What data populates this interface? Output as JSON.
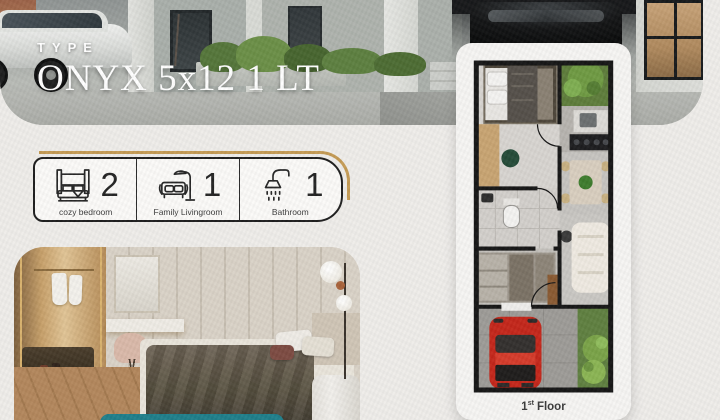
{
  "colors": {
    "background": "#efedea",
    "accent_gold": "#c59b55",
    "teal_cta": "#1f7f8b",
    "ink": "#232323",
    "card": "#f6f5f3",
    "plan_wall": "#161616",
    "car_red": "#c4271b",
    "grass_green": "#5f8040"
  },
  "header": {
    "type_label": "TYPE",
    "title": "ONYX 5x12 1 LT"
  },
  "features": {
    "items": [
      {
        "icon": "bed-icon",
        "count": "2",
        "label": "cozy bedroom"
      },
      {
        "icon": "sofa-lamp-icon",
        "count": "1",
        "label": "Family Livingroom"
      },
      {
        "icon": "shower-icon",
        "count": "1",
        "label": "Bathroom"
      }
    ]
  },
  "floorplan": {
    "caption": {
      "number": "1",
      "ordinal": "st",
      "word": "Floor"
    },
    "rooms": [
      "bedroom",
      "garden",
      "kitchen",
      "dining",
      "bathroom",
      "wardrobe",
      "living-area",
      "carport"
    ]
  },
  "photos": {
    "top": "house-exterior-with-cars",
    "bottom": "bedroom-interior"
  }
}
